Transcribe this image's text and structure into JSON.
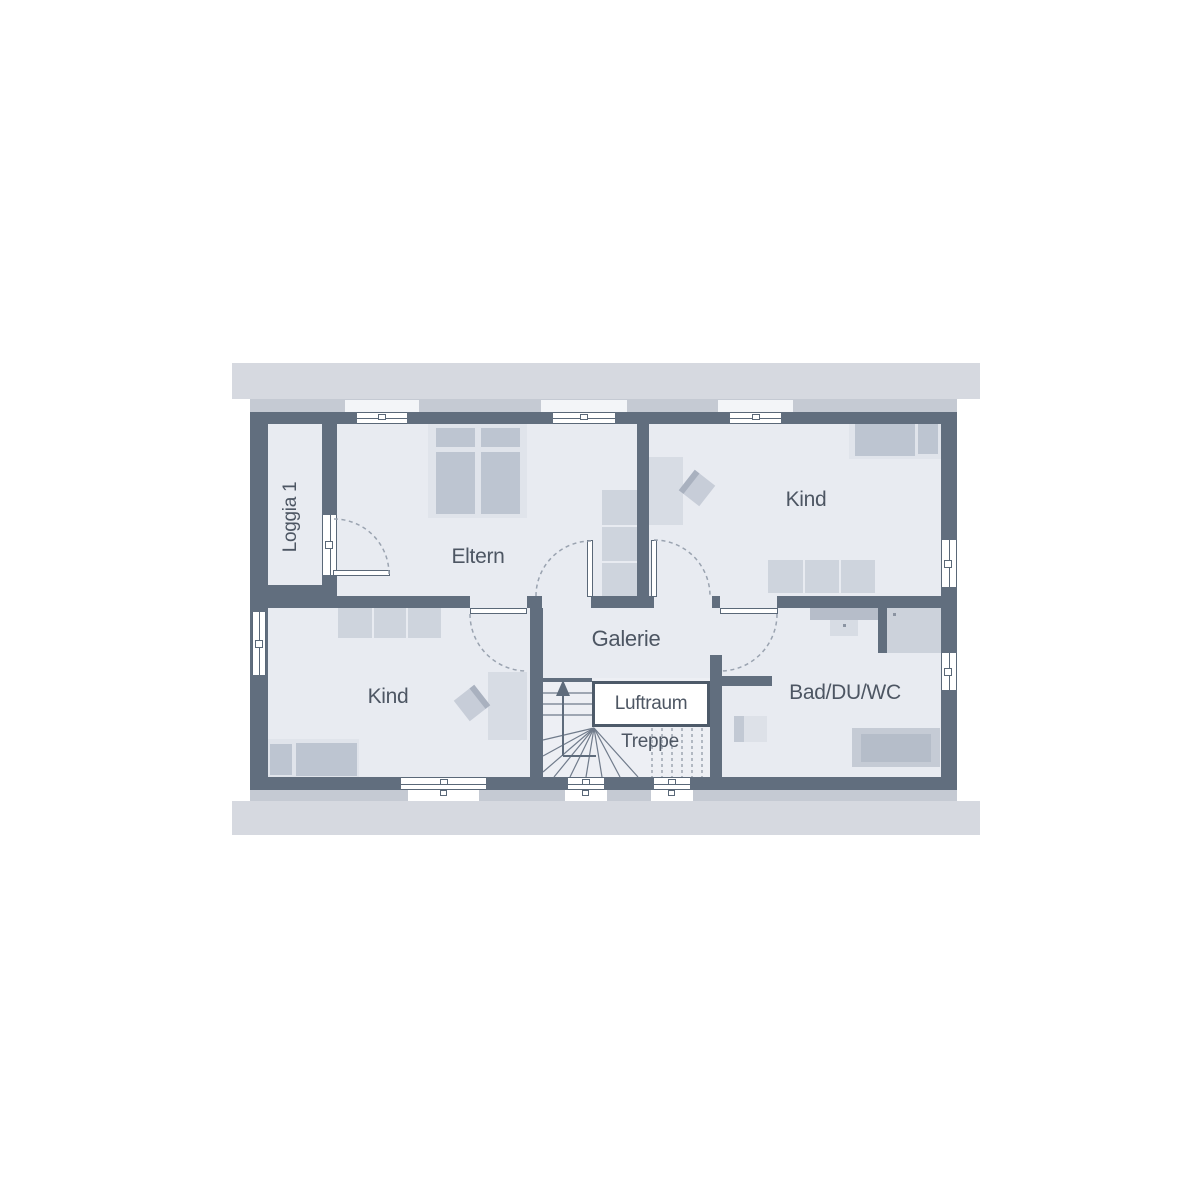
{
  "plan_type": "floor-plan-upper-storey",
  "rooms": {
    "loggia": {
      "label": "Loggia 1"
    },
    "eltern": {
      "label": "Eltern"
    },
    "kind_top_right": {
      "label": "Kind"
    },
    "kind_bottom_left": {
      "label": "Kind"
    },
    "galerie": {
      "label": "Galerie"
    },
    "luftraum": {
      "label": "Luftraum"
    },
    "treppe": {
      "label": "Treppe"
    },
    "bad_du_wc": {
      "label": "Bad/DU/WC"
    }
  },
  "colors": {
    "wall": "#616e7e",
    "room_fill": "#e8ebf1",
    "stair_fill": "#edeff4",
    "roof_band": "#d6d9e0",
    "sill_band": "#c5cad3",
    "furniture_fill": "#bdc5d1",
    "furniture_frame": "#e0e4eb",
    "furniture_medium": "#ced4dd",
    "void_fill": "#ffffff",
    "label_text": "#4d5663",
    "swing_arc": "#9aa3b0"
  },
  "icons": {
    "stair_direction_arrow": "up-arrow"
  }
}
